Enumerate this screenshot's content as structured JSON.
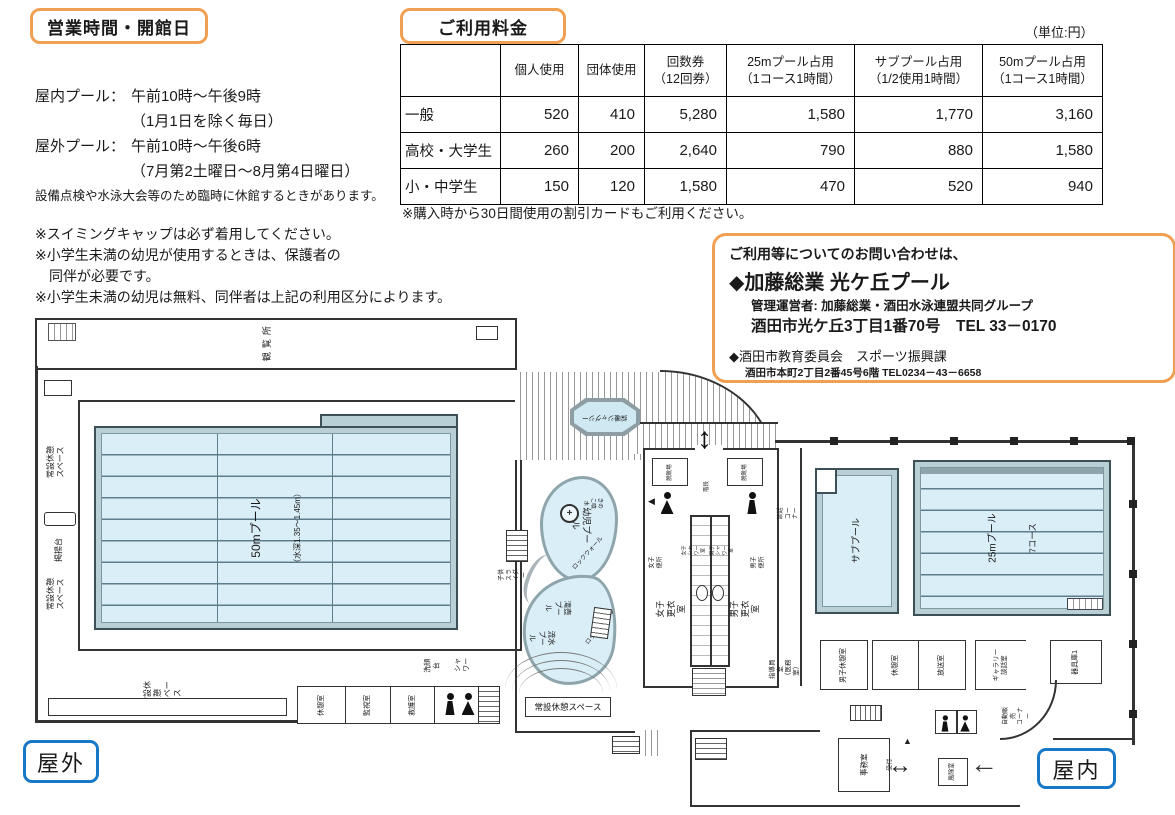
{
  "hours": {
    "title": "営業時間・開館日",
    "entries": [
      {
        "label": "屋内プール：",
        "value": "午前10時～午後9時"
      },
      {
        "label": "",
        "value": "（1月1日を除く毎日）"
      },
      {
        "label": "屋外プール：",
        "value": "午前10時～午後6時"
      },
      {
        "label": "",
        "value": "（7月第2土曜日～8月第4日曜日）"
      }
    ],
    "note": "設備点検や水泳大会等のため臨時に休館するときがあります。",
    "cautions": [
      "※スイミングキャップは必ず着用してください。",
      "※小学生未満の幼児が使用するときは、保護者の",
      "　同伴が必要です。",
      "※小学生未満の幼児は無料、同伴者は上記の利用区分によります。"
    ]
  },
  "fees": {
    "title": "ご利用料金",
    "unit": "（単位:円）",
    "columns": [
      "",
      "個人使用",
      "団体使用",
      "回数券\n（12回券）",
      "25mプール占用\n（1コース1時間）",
      "サブプール占用\n（1/2使用1時間）",
      "50mプール占用\n（1コース1時間）"
    ],
    "rows": [
      {
        "label": "一般",
        "values": [
          "520",
          "410",
          "5,280",
          "1,580",
          "1,770",
          "3,160"
        ]
      },
      {
        "label": "高校・大学生",
        "values": [
          "260",
          "200",
          "2,640",
          "790",
          "880",
          "1,580"
        ]
      },
      {
        "label": "小・中学生",
        "values": [
          "150",
          "120",
          "1,580",
          "470",
          "520",
          "940"
        ]
      }
    ],
    "note": "※購入時から30日間使用の割引カードもご利用ください。"
  },
  "contact": {
    "intro": "ご利用等についてのお問い合わせは、",
    "primary_name": "◆加藤総業 光ケ丘プール",
    "operator": "管理運営者: 加藤総業・酒田水泳連盟共同グループ",
    "address": "酒田市光ケ丘3丁目1番70号　TEL 33－0170",
    "secondary_name": "◆酒田市教育委員会　スポーツ振興課",
    "secondary_address": "酒田市本町2丁目2番45号6階 TEL0234－43－6658"
  },
  "plan": {
    "badges": {
      "outdoor": "屋外",
      "indoor": "屋内"
    },
    "labels": {
      "kanransho": "観覧所",
      "rest_space_a": "常設休憩\nスペース",
      "keiyodai": "掲揚台",
      "rest_space_b": "常設休憩\nスペース",
      "pool50_name": "50mプール",
      "pool50_depth": "（水深1.35～1.45m）",
      "rest_space_c": "常設休憩\nスペース",
      "rest_space_box": "常設休憩スペース",
      "kyukei_a": "休憩室",
      "kanshi": "監視室",
      "kyugo": "救護室",
      "sengandai": "洗顔台",
      "shower": "シャワー",
      "jacuzzi": "採暖ジャグジー",
      "yoji_pool": "幼児プール",
      "kinoko": "きのこ噴水",
      "rock_wall_a": "ロックウォール",
      "rock_wall_b": "ロックウォール",
      "kids_slider": "子供スライダー",
      "takitsubo_pool": "滝壺プール",
      "ryusui_pool": "流水プール",
      "datsukutsu_a": "脱靴場",
      "datsukutsu_b": "脱靴場",
      "kaidan": "階段",
      "joshi_benjo": "女子便所",
      "danshi_benjo": "男子便所",
      "joshi_shower": "女子シャワー室",
      "danshi_shower": "男子シャワー室",
      "joshi_koi": "女子更衣室",
      "danshi_koi": "男子更衣室",
      "danwa_corner": "談話コーナー",
      "sub_pool": "サブプール",
      "pool25_name": "25mプール",
      "pool25_lanes": "7コース",
      "shidoin": "指導員室\n（医務室）",
      "danshi_kyukei": "男子休憩室",
      "kyukei_b": "休憩室",
      "hoso": "放送室",
      "gallery": "ギャラリー\n談話室",
      "jihanbai": "自動販売\nコーナー",
      "kiguko": "器具庫1",
      "jimu": "事務室",
      "uketsuke": "受付",
      "fujo": "風除室"
    }
  }
}
